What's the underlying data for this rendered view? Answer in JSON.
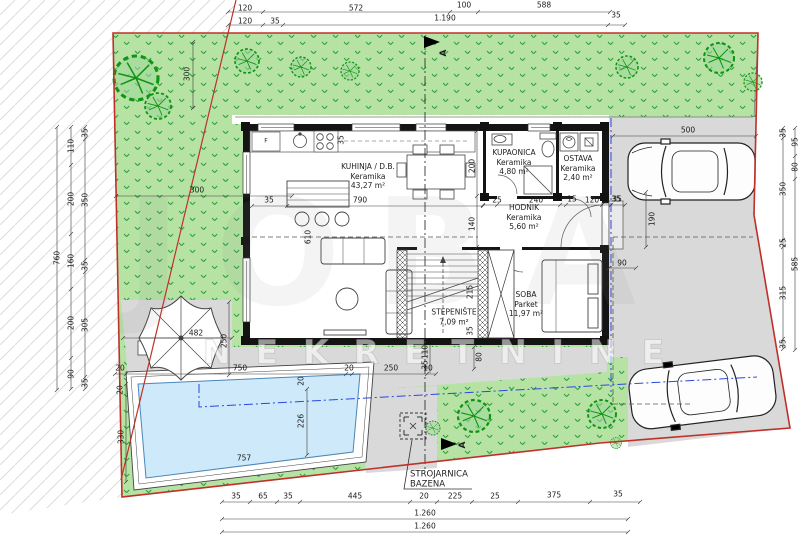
{
  "watermark": {
    "big": "JOBA",
    "small": "NEKRETNINE"
  },
  "section": {
    "label": "A"
  },
  "rooms": {
    "kuhinja": {
      "name": "KUHINJA / D.B.",
      "material": "Keramika",
      "area": "43,27 m²"
    },
    "kupaonica": {
      "name": "KUPAONICA",
      "material": "Keramika",
      "area": "4,80 m²"
    },
    "ostava": {
      "name": "OSTAVA",
      "material": "Keramika",
      "area": "2,40 m²"
    },
    "hodnik": {
      "name": "HODNIK",
      "material": "Keramika",
      "area": "5,60 m²"
    },
    "stepeniste": {
      "name": "STEPENIŠTE",
      "area": "7,09 m²"
    },
    "soba": {
      "name": "SOBA",
      "material": "Parket",
      "area": "11,97 m²"
    },
    "strojarnica": {
      "line1": "STROJARNICA",
      "line2": "BAZENA"
    }
  },
  "kitchen": {
    "fridge_label": "F"
  },
  "colors": {
    "grass": "#b6e3a4",
    "grass_mark": "#2f9e3f",
    "boundary_red": "#c03028",
    "paving_gray": "#d9d9d9",
    "pool_blue": "#cde9fa",
    "setback_blue": "#2b48e0",
    "wall_black": "#141414"
  },
  "dims": {
    "t1_a": "120",
    "t1_b": "572",
    "t1_c": "100",
    "t1_d": "588",
    "t2_a": "120",
    "t2_b": "35",
    "t2_c": "1.190",
    "t2_d": "35",
    "l1": "760",
    "l2_a": "110",
    "l2_b": "200",
    "l2_c": "160",
    "l2_d": "200",
    "l2_e": "90",
    "l3_a": "35",
    "l3_b": "350",
    "l3_c": "35",
    "l3_d": "305",
    "l3_e": "35",
    "g_v": "300",
    "g_h": "300",
    "r1_a": "35",
    "r1_b": "350",
    "r1_c": "25",
    "r1_d": "315",
    "r1_e": "35",
    "r2_a": "95",
    "r2_b": "80",
    "r2_c": "585",
    "drv_a": "500",
    "drv_b": "190",
    "drv_c": "35",
    "k_a": "35",
    "k_b": "790",
    "k_c": "35",
    "k_d": "200",
    "k_e": "140",
    "k_f": "610",
    "b_a": "25",
    "b_b": "240",
    "b_c": "15",
    "b_d": "120",
    "b_e": "35",
    "s_a": "215",
    "s_b": "35",
    "s_c": "80",
    "s_d": "90",
    "bh_a": "20",
    "bh_b": "750",
    "bh_c": "110",
    "bh_d": "35",
    "bh_e": "20",
    "bh_f": "250",
    "bh_g": "10",
    "p_a": "482",
    "p_b": "250",
    "p_c": "20",
    "p_d": "330",
    "p_e": "226",
    "p_f": "757",
    "p_g": "20",
    "bm_a": "35",
    "bm_b": "65",
    "bm_c": "35",
    "bm_d": "445",
    "bm_e": "20",
    "bm_f": "225",
    "bm_g": "25",
    "bm_h": "375",
    "bm_i": "35",
    "tot_a": "1.260",
    "tot_b": "1.260"
  }
}
